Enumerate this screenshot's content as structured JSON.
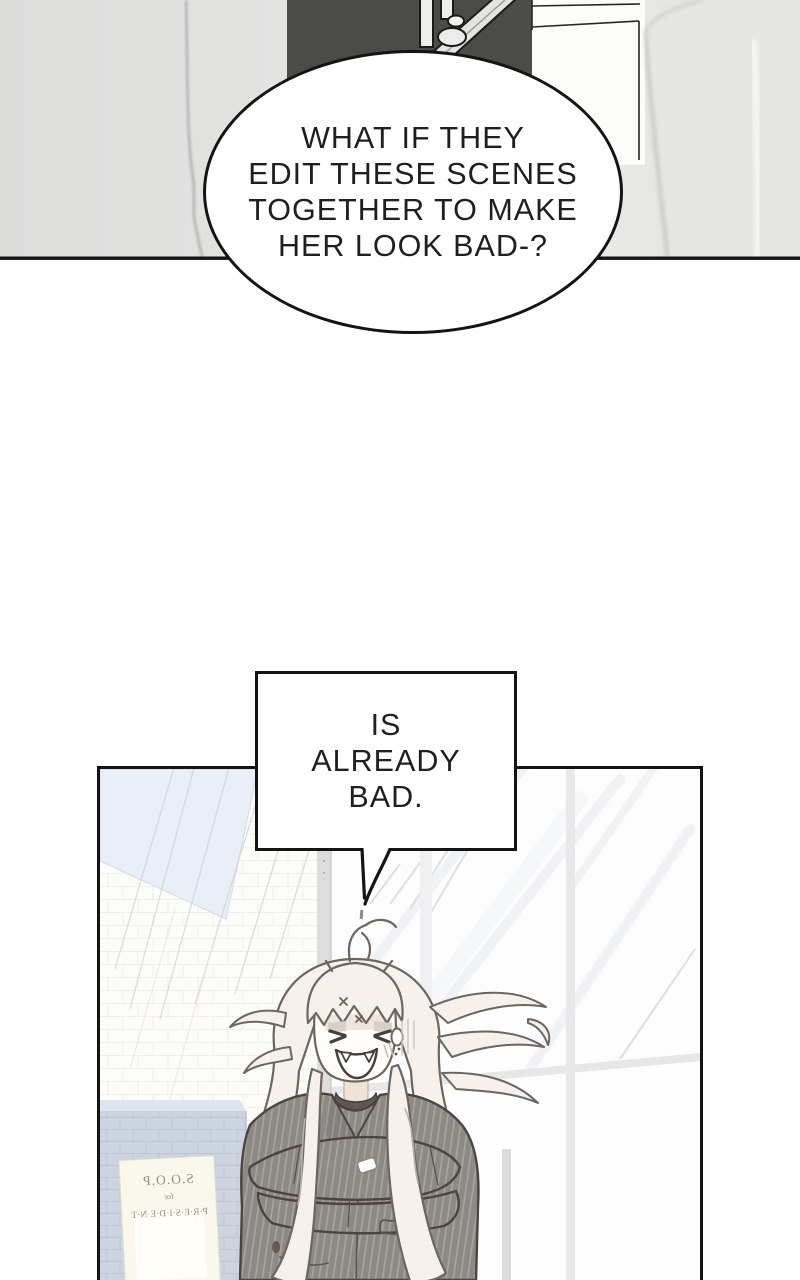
{
  "comic": {
    "dialogue": {
      "oval_bubble": {
        "lines": [
          "WHAT IF THEY",
          "EDIT THESE SCENES",
          "TOGETHER TO MAKE",
          "HER LOOK BAD-?"
        ]
      },
      "rect_bubble": {
        "lines": [
          "IS",
          "ALREADY",
          "BAD."
        ]
      }
    },
    "poster": {
      "mirrored": true,
      "lines": [
        "S.O.O.P",
        "for",
        "P·R·E·S·I·D·E·N·T"
      ]
    },
    "palette": {
      "ink": "#141414",
      "panel_gray": "#e3e3e2",
      "dark_jacket": "#4b4b49",
      "ceiling_blue": "#e9eef7",
      "pillar_blue": "#ccd4df",
      "poster_cream": "#faf7ed",
      "hair_white": "#f6f1ec",
      "coat_gray": "#8d8985",
      "skin": "#fffdfa"
    }
  }
}
